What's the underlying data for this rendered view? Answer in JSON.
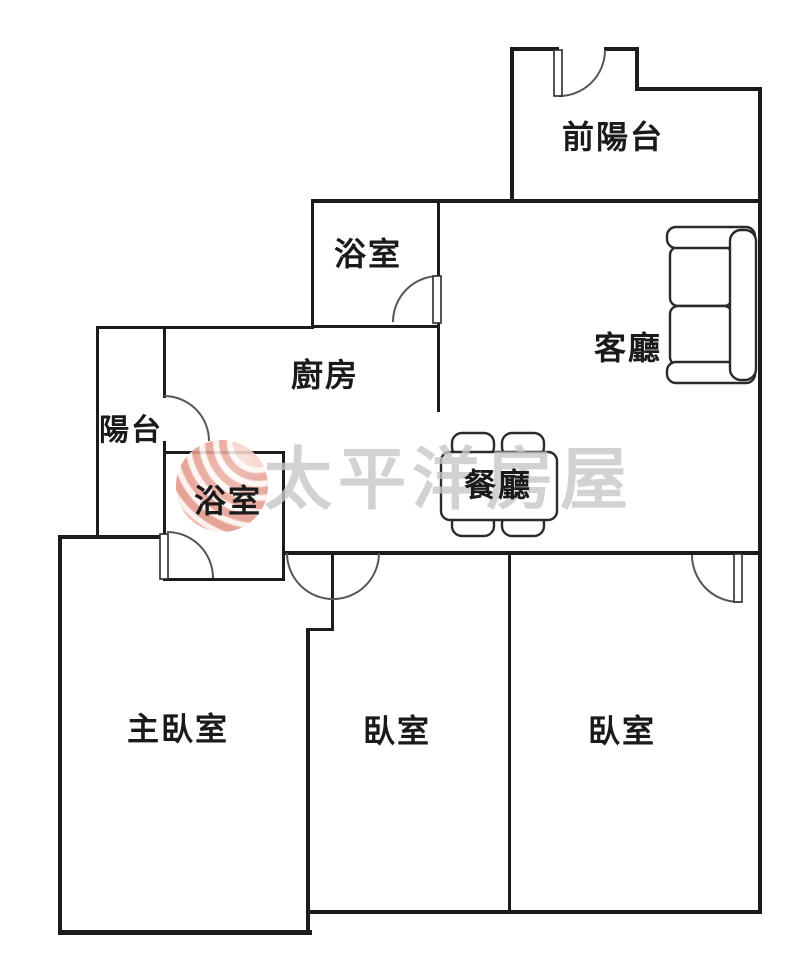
{
  "page": {
    "type": "real-estate-floor-plan",
    "background": "#ffffff"
  },
  "colors": {
    "wall": "#1c1c1c",
    "door_arc": "#555555",
    "furniture_stroke": "#2b2b2b",
    "label_text": "#1a1a1a",
    "watermark_text": "#c8c8c8",
    "logo_pink": "#f3c6bd",
    "logo_red": "#d4705f"
  },
  "rooms": [
    {
      "id": "front-balcony",
      "label": "前陽台"
    },
    {
      "id": "bathroom-upper",
      "label": "浴室"
    },
    {
      "id": "living-room",
      "label": "客廳"
    },
    {
      "id": "kitchen",
      "label": "廚房"
    },
    {
      "id": "balcony",
      "label": "陽台"
    },
    {
      "id": "bathroom-lower",
      "label": "浴室"
    },
    {
      "id": "dining-room",
      "label": "餐廳"
    },
    {
      "id": "master-bedroom",
      "label": "主臥室"
    },
    {
      "id": "bedroom-middle",
      "label": "臥室"
    },
    {
      "id": "bedroom-right",
      "label": "臥室"
    }
  ],
  "watermark": {
    "brand_text": "太平洋房屋"
  },
  "icons": {
    "sofa": "sofa-top-view",
    "dining_set": "dining-table-with-4-chairs",
    "brand_logo": "wave-sphere-logo"
  }
}
